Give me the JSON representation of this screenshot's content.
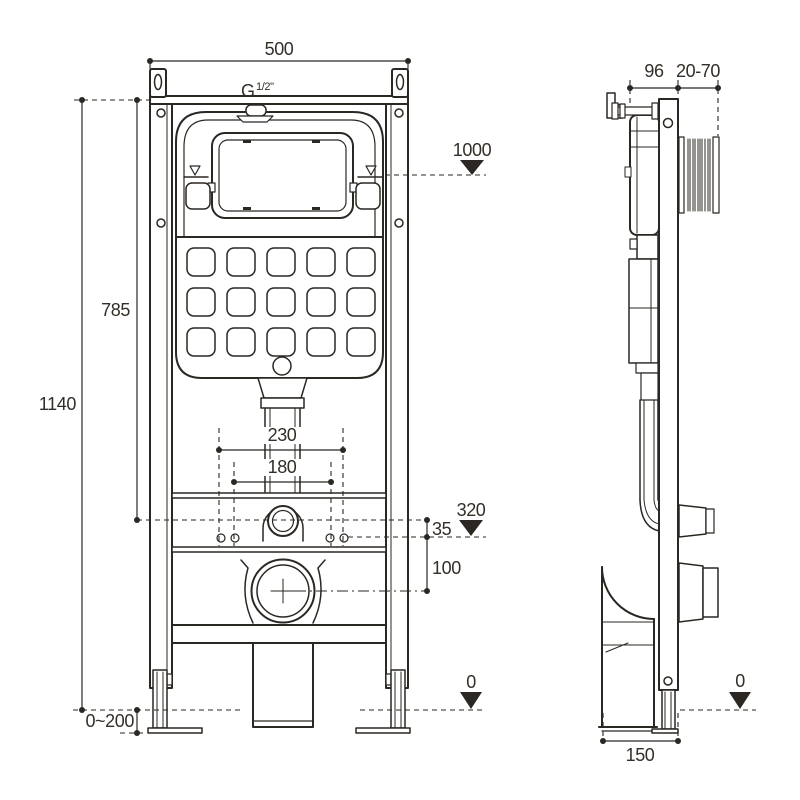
{
  "colors": {
    "background": "#ffffff",
    "line": "#2b2722",
    "text": "#332e27"
  },
  "drawing": {
    "type": "technical-installation-diagram",
    "subject": "concealed-cistern-wc-frame"
  },
  "front_view": {
    "frame_width": "500",
    "total_height": "1140",
    "tank_height": "785",
    "flush_plate_level": "1000",
    "thread_g": "G",
    "thread_size": "1/2\"",
    "fixing_width_outer": "230",
    "fixing_width_inner": "180",
    "inlet_level": "320",
    "inlet_offset": "35",
    "outlet_offset": "100",
    "floor_level": "0",
    "foot_adjust_range": "0~200"
  },
  "side_view": {
    "top_depth": "96",
    "wall_distance_range": "20-70",
    "floor_level": "0",
    "base_depth": "150"
  }
}
